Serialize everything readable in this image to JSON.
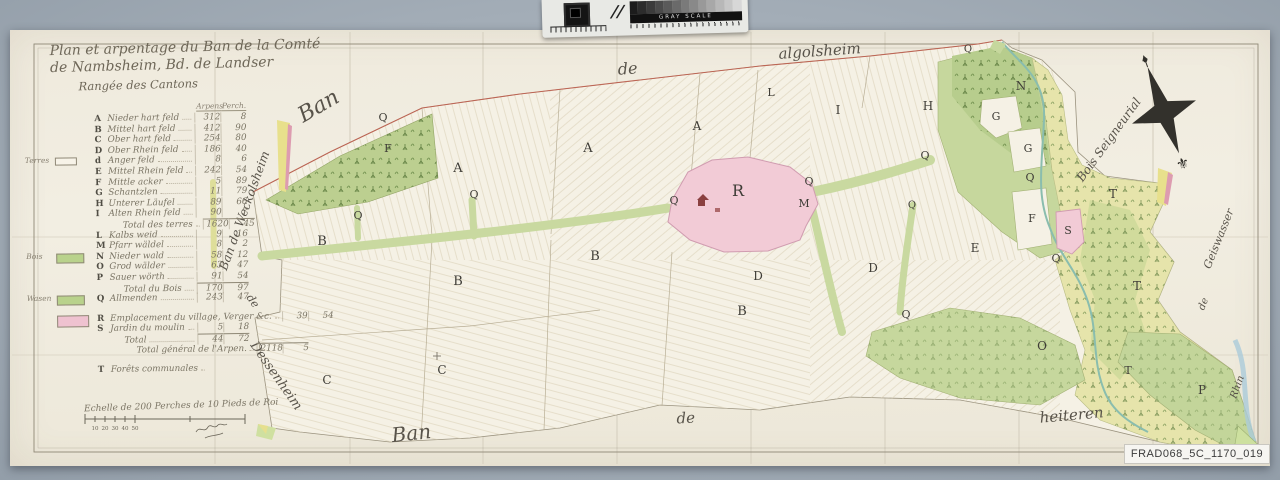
{
  "archive": {
    "reference": "FRAD068_5C_1170_019"
  },
  "calibration": {
    "bar_label": "GRAY SCALE",
    "steps": 13
  },
  "colors": {
    "background_gray": "#a3adb7",
    "paper": "#f0ecdf",
    "commons_green": "#c9d9a0",
    "forest_green": "#b7cd8d",
    "riparian_yellow": "#e6e4ab",
    "village_pink": "#f2cbd6",
    "boundary_red": "#c05a4a",
    "stream_teal": "#8abdae",
    "ink": "#56524a"
  },
  "title": {
    "line1": "Plan et arpentage du Ban de la Comté",
    "line2": "de Nambsheim, Bd. de Landser",
    "line3": "Rangée des Cantons"
  },
  "legend": {
    "col_headers": [
      "Arpens",
      "Perch."
    ],
    "rows": [
      {
        "key": "A",
        "name": "Nieder hart feld",
        "arpens": "312",
        "perches": "8"
      },
      {
        "key": "B",
        "name": "Mittel hart feld",
        "arpens": "412",
        "perches": "90"
      },
      {
        "key": "C",
        "name": "Ober hart feld",
        "arpens": "254",
        "perches": "80"
      },
      {
        "key": "D",
        "name": "Ober Rhein feld",
        "arpens": "186",
        "perches": "40"
      },
      {
        "key": "d",
        "name": "Anger feld",
        "arpens": "8",
        "perches": "6",
        "swatch": "outline",
        "word": "Terres"
      },
      {
        "key": "E",
        "name": "Mittel Rhein feld",
        "arpens": "242",
        "perches": "54"
      },
      {
        "key": "F",
        "name": "Mittle acker",
        "arpens": "5",
        "perches": "89"
      },
      {
        "key": "G",
        "name": "Schantzlen",
        "arpens": "11",
        "perches": "79"
      },
      {
        "key": "H",
        "name": "Unterer Läufel",
        "arpens": "89",
        "perches": "66"
      },
      {
        "key": "I",
        "name": "Alten Rhein feld",
        "arpens": "90",
        "perches": "7"
      },
      {
        "key": "",
        "name": "Total des terres",
        "arpens": "1620",
        "perches": "45",
        "total": true
      },
      {
        "key": "L",
        "name": "Kalbs weid",
        "arpens": "9",
        "perches": "16"
      },
      {
        "key": "M",
        "name": "Pfarr wäldel",
        "arpens": "8",
        "perches": "2"
      },
      {
        "key": "N",
        "name": "Nieder wald",
        "arpens": "58",
        "perches": "12",
        "swatch": "green",
        "word": "Bois"
      },
      {
        "key": "O",
        "name": "Grod wälder",
        "arpens": "63",
        "perches": "47"
      },
      {
        "key": "P",
        "name": "Sauer wörth",
        "arpens": "91",
        "perches": "54"
      },
      {
        "key": "",
        "name": "Total du Bois",
        "arpens": "170",
        "perches": "97",
        "total": true
      },
      {
        "key": "Q",
        "name": "Allmenden",
        "arpens": "243",
        "perches": "47",
        "swatch": "green",
        "word": "Wasen"
      },
      {
        "key": "R",
        "name": "Emplacement du village, Verger &c.",
        "arpens": "39",
        "perches": "54",
        "swatch": "pink",
        "gap": true
      },
      {
        "key": "S",
        "name": "Jardin du moulin",
        "arpens": "5",
        "perches": "18"
      },
      {
        "key": "",
        "name": "Total",
        "arpens": "44",
        "perches": "72",
        "total": true
      },
      {
        "key": "",
        "name": "Total général de l'Arpen.",
        "arpens": "2118",
        "perches": "5",
        "total": true,
        "grand": true
      },
      {
        "key": "T",
        "name": "Forêts communales",
        "arpens": "",
        "perches": "",
        "gap": true
      }
    ]
  },
  "scale": {
    "caption": "Echelle de 200 Perches de 10 Pieds de Roi",
    "tick_labels": [
      "10",
      "20",
      "30",
      "40",
      "50"
    ]
  },
  "map": {
    "compass_glyph": "⚜",
    "neighbor_labels": [
      {
        "text": "algolsheim",
        "x": 820,
        "y": 56,
        "rot": -4,
        "size": 15
      },
      {
        "text": "Ban",
        "x": 322,
        "y": 112,
        "rot": -30,
        "size": 22
      },
      {
        "text": "de",
        "x": 628,
        "y": 74,
        "rot": -4,
        "size": 16
      },
      {
        "text": "Ban de Weckolsheim",
        "x": 248,
        "y": 212,
        "rot": -70,
        "size": 12
      },
      {
        "text": "de",
        "x": 250,
        "y": 303,
        "rot": 55,
        "size": 11
      },
      {
        "text": "Dessenheim",
        "x": 273,
        "y": 378,
        "rot": 55,
        "size": 13
      },
      {
        "text": "Ban",
        "x": 412,
        "y": 440,
        "rot": -6,
        "size": 20
      },
      {
        "text": "de",
        "x": 686,
        "y": 423,
        "rot": -3,
        "size": 15
      },
      {
        "text": "heiteren",
        "x": 1072,
        "y": 420,
        "rot": -5,
        "size": 15
      },
      {
        "text": "Bois Seigneurial",
        "x": 1112,
        "y": 142,
        "rot": -54,
        "size": 12
      },
      {
        "text": "de",
        "x": 1206,
        "y": 305,
        "rot": -68,
        "size": 10
      },
      {
        "text": "Geiswasser",
        "x": 1222,
        "y": 240,
        "rot": -68,
        "size": 11
      },
      {
        "text": "Rhin",
        "x": 1240,
        "y": 388,
        "rot": -70,
        "size": 10
      }
    ],
    "parcel_labels": [
      {
        "t": "A",
        "x": 458,
        "y": 172,
        "s": 13
      },
      {
        "t": "A",
        "x": 588,
        "y": 152,
        "s": 13
      },
      {
        "t": "A",
        "x": 697,
        "y": 130,
        "s": 12
      },
      {
        "t": "B",
        "x": 322,
        "y": 245,
        "s": 13
      },
      {
        "t": "B",
        "x": 458,
        "y": 285,
        "s": 13
      },
      {
        "t": "B",
        "x": 595,
        "y": 260,
        "s": 13
      },
      {
        "t": "B",
        "x": 742,
        "y": 315,
        "s": 13
      },
      {
        "t": "C",
        "x": 327,
        "y": 384,
        "s": 12
      },
      {
        "t": "C",
        "x": 442,
        "y": 374,
        "s": 12
      },
      {
        "t": "D",
        "x": 758,
        "y": 280,
        "s": 12
      },
      {
        "t": "D",
        "x": 873,
        "y": 272,
        "s": 12
      },
      {
        "t": "E",
        "x": 975,
        "y": 252,
        "s": 12
      },
      {
        "t": "F",
        "x": 388,
        "y": 152,
        "s": 11
      },
      {
        "t": "F",
        "x": 1032,
        "y": 222,
        "s": 11
      },
      {
        "t": "G",
        "x": 996,
        "y": 120,
        "s": 11
      },
      {
        "t": "G",
        "x": 1028,
        "y": 152,
        "s": 11
      },
      {
        "t": "H",
        "x": 928,
        "y": 110,
        "s": 12
      },
      {
        "t": "I",
        "x": 838,
        "y": 114,
        "s": 12
      },
      {
        "t": "L",
        "x": 771,
        "y": 96,
        "s": 11
      },
      {
        "t": "M",
        "x": 804,
        "y": 207,
        "s": 11
      },
      {
        "t": "N",
        "x": 1021,
        "y": 90,
        "s": 12
      },
      {
        "t": "O",
        "x": 1042,
        "y": 350,
        "s": 12
      },
      {
        "t": "P",
        "x": 1202,
        "y": 394,
        "s": 12
      },
      {
        "t": "Q",
        "x": 383,
        "y": 121,
        "s": 11
      },
      {
        "t": "Q",
        "x": 358,
        "y": 219,
        "s": 11
      },
      {
        "t": "Q",
        "x": 474,
        "y": 198,
        "s": 11
      },
      {
        "t": "Q",
        "x": 674,
        "y": 204,
        "s": 11
      },
      {
        "t": "Q",
        "x": 809,
        "y": 185,
        "s": 11
      },
      {
        "t": "Q",
        "x": 925,
        "y": 159,
        "s": 11
      },
      {
        "t": "Q",
        "x": 912,
        "y": 208,
        "s": 10
      },
      {
        "t": "Q",
        "x": 906,
        "y": 318,
        "s": 11
      },
      {
        "t": "Q",
        "x": 1030,
        "y": 181,
        "s": 11
      },
      {
        "t": "Q",
        "x": 1056,
        "y": 262,
        "s": 11
      },
      {
        "t": "Q",
        "x": 968,
        "y": 52,
        "s": 10
      },
      {
        "t": "R",
        "x": 738,
        "y": 196,
        "s": 16
      },
      {
        "t": "S",
        "x": 1068,
        "y": 234,
        "s": 11
      },
      {
        "t": "T",
        "x": 1113,
        "y": 198,
        "s": 12
      },
      {
        "t": "T",
        "x": 1137,
        "y": 290,
        "s": 12
      },
      {
        "t": "T",
        "x": 1128,
        "y": 374,
        "s": 11
      }
    ]
  }
}
